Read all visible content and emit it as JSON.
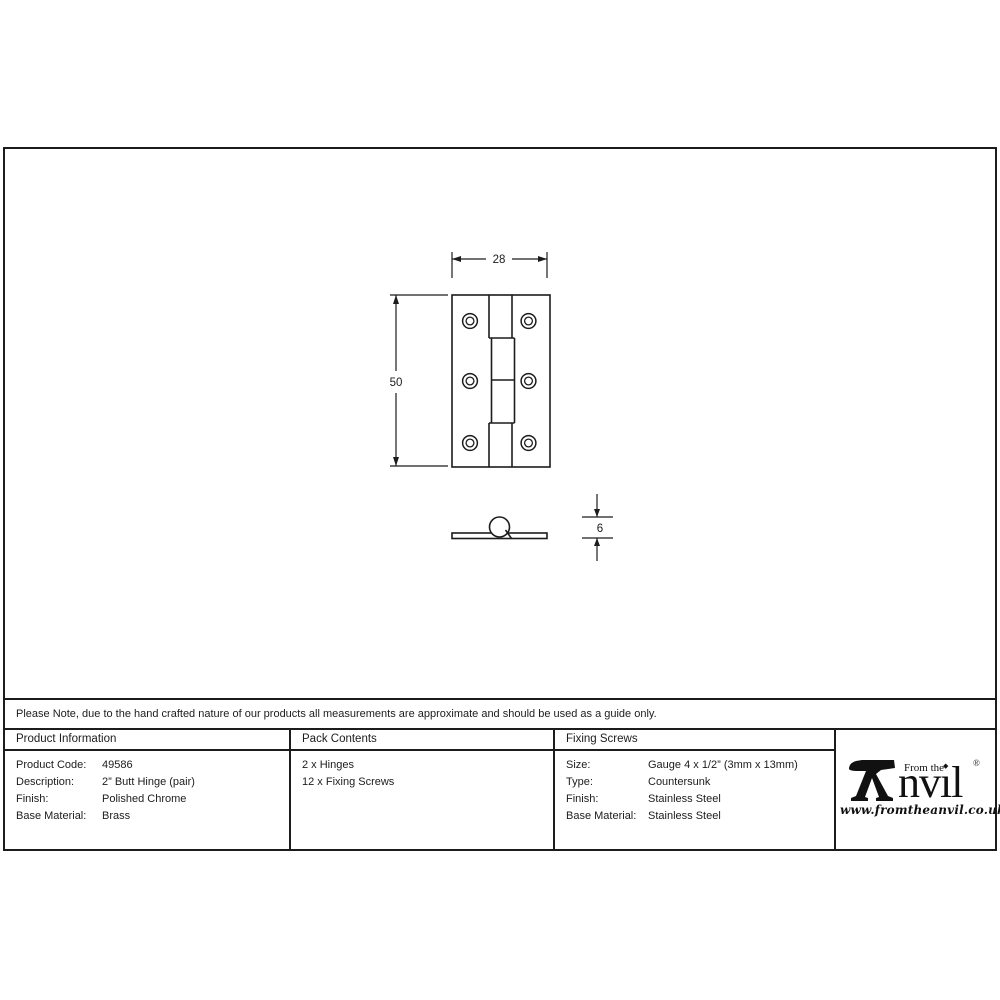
{
  "sheet": {
    "note": "Please Note, due to the hand crafted nature of our products all measurements are approximate and should be used as a guide only."
  },
  "drawing": {
    "width_label": "28",
    "height_label": "50",
    "thickness_label": "6"
  },
  "table": {
    "product_info": {
      "header": "Product Information",
      "rows": [
        {
          "label": "Product Code:",
          "value": "49586"
        },
        {
          "label": "Description:",
          "value": "2” Butt Hinge (pair)"
        },
        {
          "label": "Finish:",
          "value": "Polished Chrome"
        },
        {
          "label": "Base Material:",
          "value": "Brass"
        }
      ]
    },
    "pack_contents": {
      "header": "Pack Contents",
      "items": [
        "2 x Hinges",
        "12 x Fixing Screws"
      ]
    },
    "fixing_screws": {
      "header": "Fixing Screws",
      "rows": [
        {
          "label": "Size:",
          "value": "Gauge 4 x 1/2” (3mm x 13mm)"
        },
        {
          "label": "Type:",
          "value": "Countersunk"
        },
        {
          "label": "Finish:",
          "value": "Stainless Steel"
        },
        {
          "label": "Base Material:",
          "value": "Stainless Steel"
        }
      ]
    }
  },
  "logo": {
    "from_the": "From the",
    "brand": "nvıl",
    "i_dot": "◆",
    "registered": "®",
    "url": "www.fromtheanvil.co.uk"
  },
  "colors": {
    "line": "#1c1c1c",
    "background": "#ffffff"
  }
}
